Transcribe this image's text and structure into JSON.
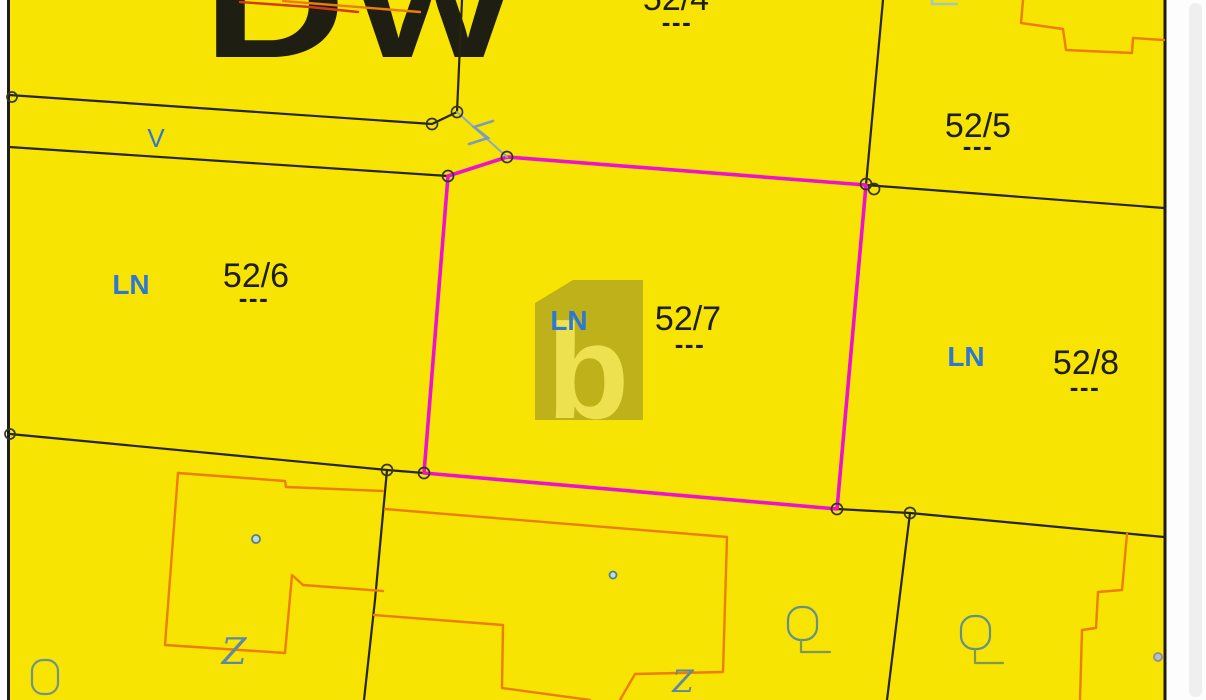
{
  "map": {
    "background_color": "#f7e403",
    "boundary_color": "#26250f",
    "building_color": "#ee7d05",
    "building_color_red": "#d43a12",
    "highlight_color": "#ec13cf",
    "label_blue": "#2e78d4",
    "symbol_teal": "#6f9584",
    "tie_line_blue": "#8fa9c2",
    "large_land_use_label": "Dw",
    "road_label": "V",
    "watermark_letter": "b",
    "parcels": [
      {
        "number": "52/4",
        "land_use": "",
        "separator": "---"
      },
      {
        "number": "52/5",
        "land_use": "",
        "separator": "---"
      },
      {
        "number": "52/6",
        "land_use": "LN",
        "separator": "---"
      },
      {
        "number": "52/7",
        "land_use": "LN",
        "separator": "---",
        "highlighted": true
      },
      {
        "number": "52/8",
        "land_use": "LN",
        "separator": "---"
      }
    ],
    "symbols": {
      "culvert_label": "Z"
    }
  }
}
